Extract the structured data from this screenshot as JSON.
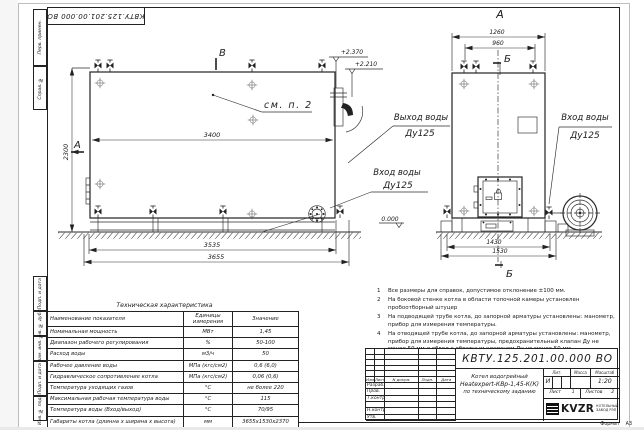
{
  "doc_number": "КВТУ.125.201.00.000  ВО",
  "format": {
    "label": "Формат",
    "value": "А3"
  },
  "margin": {
    "labels": [
      "Перв. примен.",
      "Справ. №",
      "Подп. и дата",
      "Инв. № дубл.",
      "Взам. инв. №",
      "Подп. и дата",
      "Инв. № подл."
    ]
  },
  "drawing": {
    "marks": {
      "a_side": "А",
      "b_top": "В",
      "a_front": "А",
      "b_front_top": "Б",
      "b_front_bottom": "Б"
    },
    "callout": "см. п. 2",
    "elevations": {
      "top": "+2.370",
      "mid": "+2.210",
      "zero": "0.000"
    },
    "dims": {
      "side_inner": "3400",
      "side_height": "2300",
      "side_base": "3535",
      "side_total": "3655",
      "front_top": "1260",
      "front_top_inner": "960",
      "front_base": "1430",
      "front_total": "1530"
    },
    "pipes": {
      "outlet": {
        "l1": "Выход воды",
        "l2": "Ду125"
      },
      "inlet_side": {
        "l1": "Вход воды",
        "l2": "Ду125"
      },
      "inlet_front": {
        "l1": "Вход воды",
        "l2": "Ду125"
      }
    }
  },
  "notes": {
    "items": [
      {
        "n": "1",
        "text": "Все размеры для справок, допустимое отклонение ±100 мм."
      },
      {
        "n": "2",
        "text": "На боковой стенке котла в области топочной камеры установлен пробоотборный штуцер"
      },
      {
        "n": "3",
        "text": "На подводящей трубе котла, до запорной арматуры установлены: манометр, прибор для измерения температуры."
      },
      {
        "n": "4",
        "text": "На отводящей трубе котла, до запорной арматуры установлены: манометр, прибор для измерения температуры, предохранительный клапан Ду не менее 50 мм и обвод с обратным клапаном Ду не менее 50 мм."
      }
    ]
  },
  "tech_table": {
    "title": "Техническая характеристика",
    "headers": [
      "Наименование показателя",
      "Единицы измерения",
      "Значение"
    ],
    "rows": [
      [
        "Номинальная мощность",
        "МВт",
        "1,45"
      ],
      [
        "Диапазон рабочего регулирования",
        "%",
        "50-100"
      ],
      [
        "Расход воды",
        "м3/ч",
        "50"
      ],
      [
        "Рабочее давление воды",
        "МПа (кгс/см2)",
        "0,6 (6,0)"
      ],
      [
        "Гидравлическое сопротивление котла",
        "МПа (кгс/см2)",
        "0,06 (0,6)"
      ],
      [
        "Температура уходящих газов",
        "°С",
        "не более 220"
      ],
      [
        "Максимальная рабочая температура воды",
        "°С",
        "115"
      ],
      [
        "Температура воды (Вход/выход)",
        "°С",
        "70/95"
      ],
      [
        "Габариты котла (длинна х ширина х высота)",
        "мм",
        "3655х1530х2370"
      ]
    ]
  },
  "title_block": {
    "rev_headers": {
      "izm": "Изм",
      "list": "Лист",
      "ndoc": "N докум.",
      "podp": "Подп.",
      "data": "Дата"
    },
    "roles": [
      "Разраб.",
      "Пров.",
      "Т.контр.",
      "",
      "Н.контр.",
      "Утв."
    ],
    "product": [
      "Котел водогрейный",
      "Heatexpert-КВр-1,45-К(К)",
      "по техническому заданию"
    ],
    "lit_label": "Лит.",
    "lit_value": "И",
    "mass_label": "Масса",
    "scale_label": "Масштаб",
    "scale_value": "1:20",
    "sheet_label": "Лист",
    "sheet_value": "1",
    "sheets_label": "Листов",
    "sheets_value": "2",
    "company": {
      "logo": "KVZR",
      "sub1": "КОТЕЛЬНЫЙ",
      "sub2": "ЗАВОД РЭП"
    }
  }
}
